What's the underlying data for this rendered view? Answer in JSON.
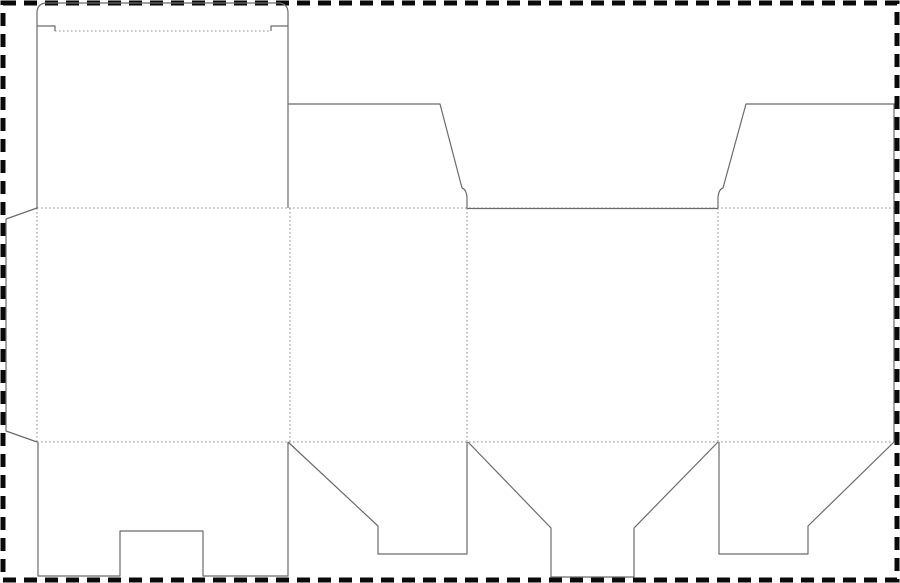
{
  "canvas": {
    "width": 900,
    "height": 583,
    "background": "#ffffff"
  },
  "diagram": {
    "type": "packaging-dieline",
    "title": "folding-carton dieline template",
    "colors": {
      "cut_line": "#6a6a6a",
      "fold_line": "#8f8f8f",
      "border": "#0a0a0a",
      "background": "#ffffff"
    },
    "border": {
      "inset": 3,
      "thickness": 5,
      "dash": 13,
      "gap": 8
    },
    "fold_style": {
      "width": 1,
      "dash": "1.6 2.4"
    },
    "cut_style": {
      "width": 1.2
    },
    "cut_paths": [
      {
        "name": "left-panel-and-tuck-flap-outline",
        "d": "M 37 208 L 37 13 Q 37 3 47 3 L 278 3 Q 288 3 288 13 L 288 208"
      },
      {
        "name": "tuck-flap-shoulder-left",
        "d": "M 37 26 L 55 26 L 55 31"
      },
      {
        "name": "tuck-flap-shoulder-right",
        "d": "M 288 26 L 271 26 L 271 31"
      },
      {
        "name": "top-dust-flap-left",
        "d": "M 288 104 L 440 104 L 462 188 Q 466 189 467 197 L 467 208"
      },
      {
        "name": "front-panel-top-cut",
        "d": "M 467 208.5 L 718 208.5"
      },
      {
        "name": "top-dust-flap-right-and-right-edge",
        "d": "M 718 208 L 718 197 Q 719 189 723 188 L 746 104 L 894 104 L 894 442"
      },
      {
        "name": "bottom-dust-flap-left",
        "d": "M 288 442 L 378 526 L 378 554 L 467 554 L 467 442"
      },
      {
        "name": "bottom-lock-flap-center",
        "d": "M 468 442 L 551 528 L 551 577 L 634 577 L 634 528 L 718 442"
      },
      {
        "name": "bottom-dust-flap-right",
        "d": "M 719 442 L 719 554 L 808 554 L 808 526 L 894 442"
      },
      {
        "name": "bottom-lid-with-thumb-notch",
        "d": "M 38 442 L 38 576 L 120 576 L 120 531 L 203 531 L 203 576 L 288 576 L 288 442"
      },
      {
        "name": "glue-tab",
        "d": "M 37 208 L 6 219 L 6 431 L 37 442"
      }
    ],
    "fold_lines": [
      {
        "name": "tuck-flap-crease",
        "x1": 55,
        "y1": 31,
        "x2": 271,
        "y2": 31
      },
      {
        "name": "upper-horizontal-crease",
        "x1": 37,
        "y1": 208,
        "x2": 894,
        "y2": 208
      },
      {
        "name": "lower-horizontal-crease",
        "x1": 37,
        "y1": 442,
        "x2": 894,
        "y2": 442
      },
      {
        "name": "glue-tab-crease",
        "x1": 37,
        "y1": 208,
        "x2": 37,
        "y2": 442
      },
      {
        "name": "panel-crease-1",
        "x1": 290,
        "y1": 208,
        "x2": 290,
        "y2": 442
      },
      {
        "name": "panel-crease-2",
        "x1": 467,
        "y1": 208,
        "x2": 467,
        "y2": 442
      },
      {
        "name": "panel-crease-3",
        "x1": 718,
        "y1": 208,
        "x2": 718,
        "y2": 442
      }
    ]
  }
}
